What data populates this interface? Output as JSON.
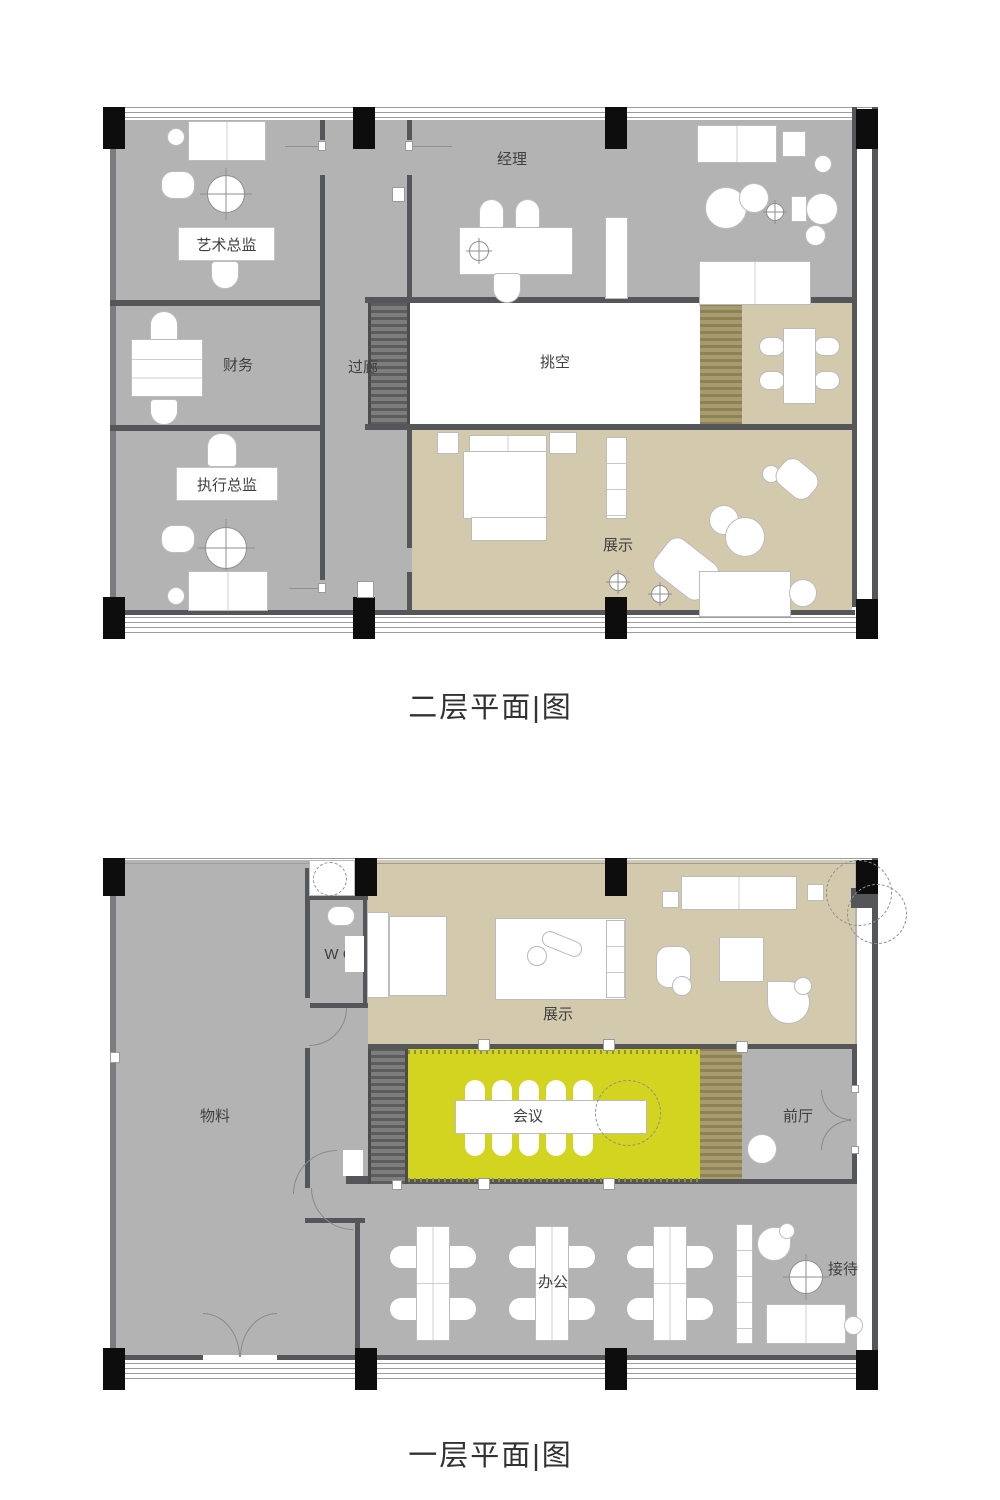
{
  "colors": {
    "floor_gray": "#b3b3b3",
    "wall_dark": "#55565a",
    "beige": "#d3caae",
    "accent_yellow": "#d3d41f",
    "wood": "#a89b6e",
    "column_black": "#0d0d0d"
  },
  "plans": [
    {
      "id": "second-floor",
      "title": "二层平面|图",
      "labels": {
        "art_director": "艺术总监",
        "manager": "经理",
        "finance": "财务",
        "corridor": "过廊",
        "void": "挑空",
        "exec_director": "执行总监",
        "display": "展示"
      }
    },
    {
      "id": "first-floor",
      "title": "一层平面|图",
      "labels": {
        "wc": "W C",
        "materials": "物料",
        "display": "展示",
        "meeting": "会议",
        "front_hall": "前厅",
        "office": "办公",
        "reception": "接待"
      }
    }
  ]
}
